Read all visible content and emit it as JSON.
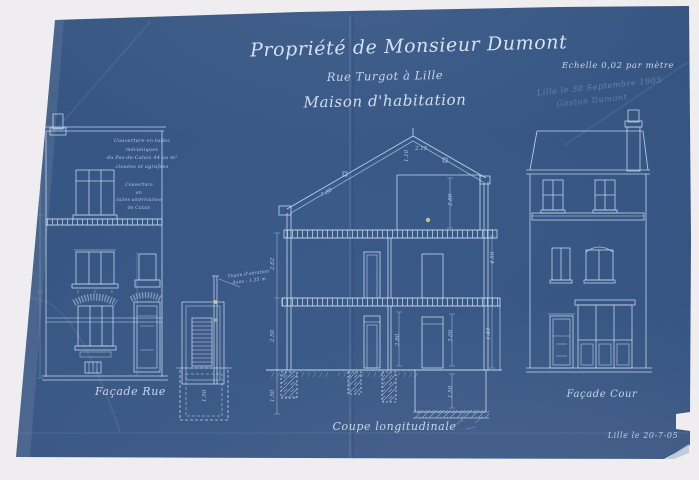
{
  "labels": {
    "title1": "Propriété de Monsieur Dumont",
    "title2": "Rue Turgot à Lille",
    "title3": "Maison d'habitation",
    "scale": "Echelle 0,02 par mètre",
    "sig1": "Lille le 30 Septembre 1905",
    "sig2": "Gaston Dumont",
    "facade_rue": "Façade Rue",
    "coupe": "Coupe longitudinale",
    "facade_cour": "Façade Cour",
    "date": "Lille le 20-7-05"
  },
  "annotations": {
    "roof1": "Couverture en tuiles mécaniques",
    "roof2": "du Pas-de-Calais 44 au m²",
    "roof3": "clouées et agrafées",
    "wall1": "Couverture",
    "wall2": "en",
    "wall3": "tuiles américaines",
    "wall4": "de Calais",
    "pipe1": "Tuyau d'aération",
    "pipe2": "dans : 1,35 m"
  },
  "dims": [
    "2.15",
    "1.10",
    "7.88",
    "2.80",
    "2.62",
    "2.50",
    "1.50",
    "2.80",
    "3.00",
    "1.50",
    "1.40",
    "4.50",
    "1.50"
  ],
  "colors": {
    "paper": "#efedef",
    "blueprint_blue": "#33517d",
    "line_white": "#d5e4f8",
    "ink_white": "#dce9fb"
  }
}
